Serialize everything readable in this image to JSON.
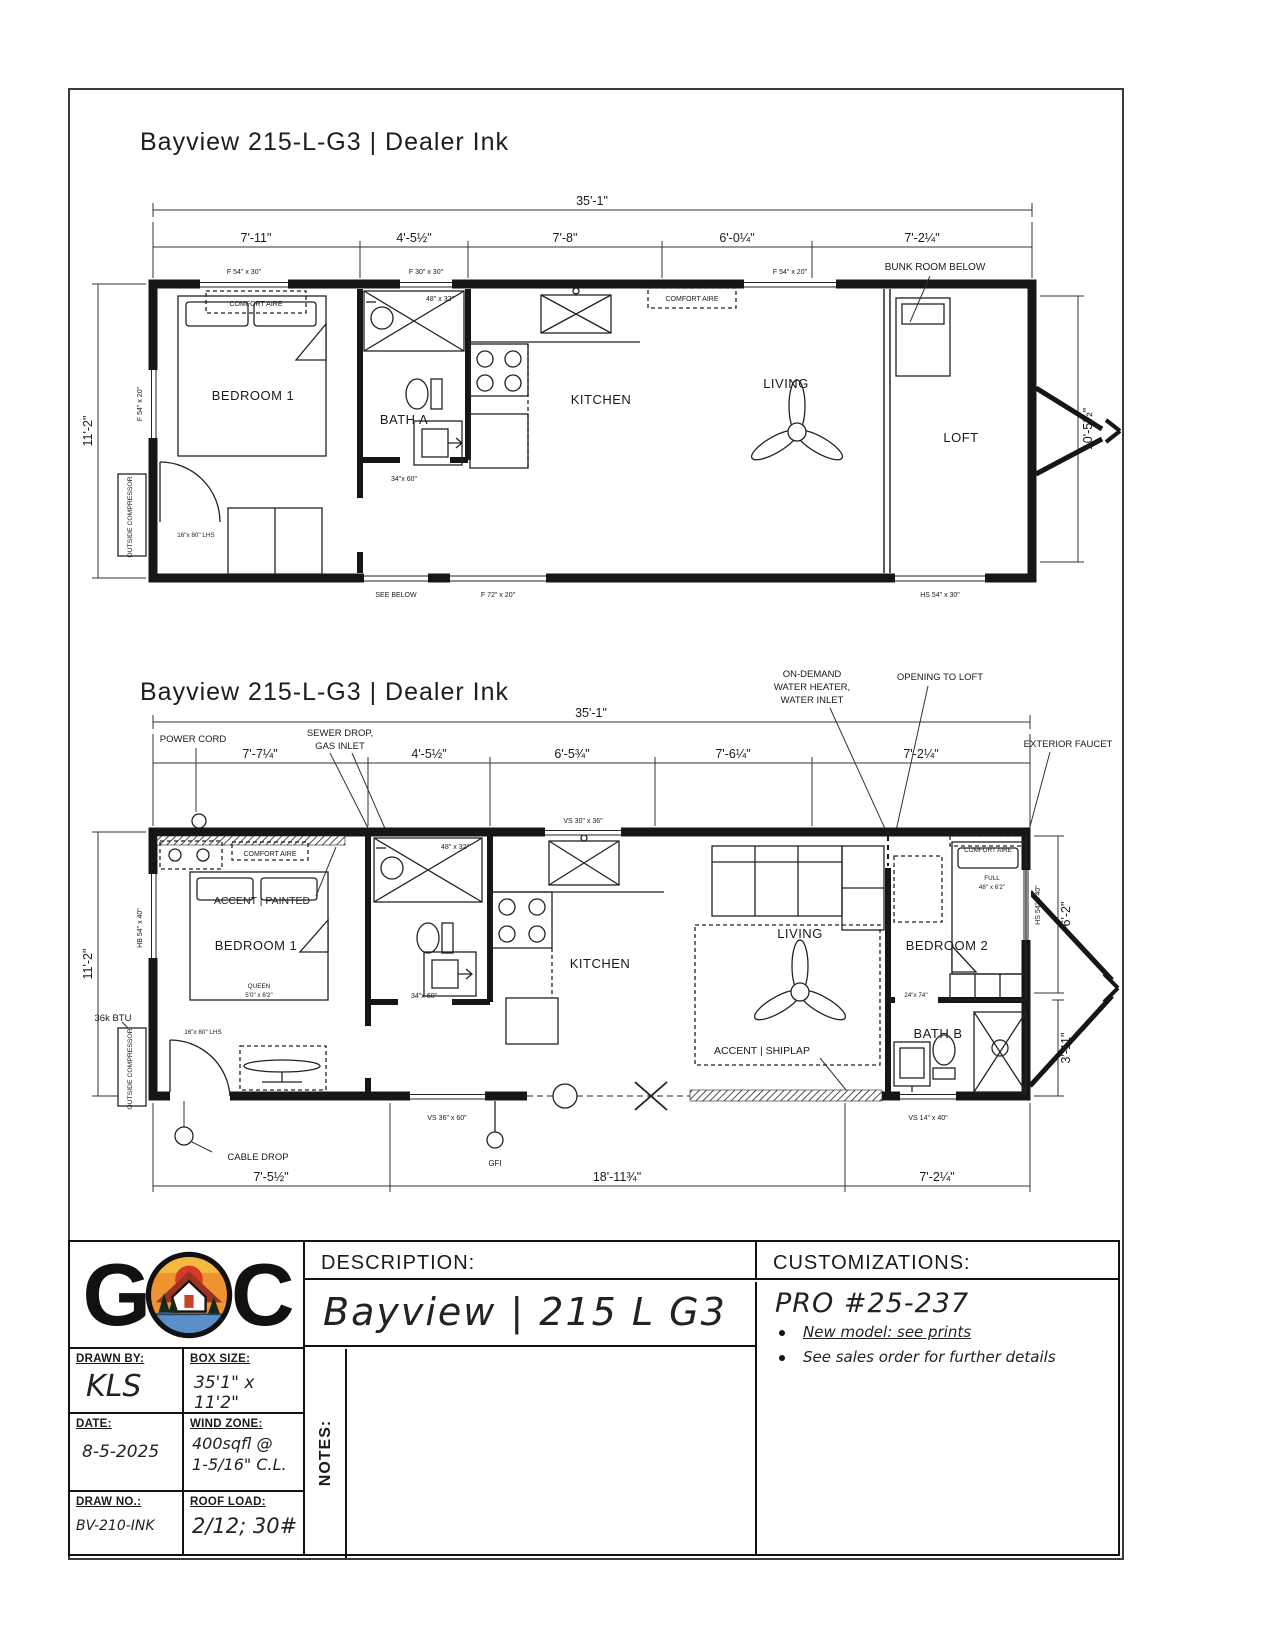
{
  "doc": {
    "title": "Bayview 215-L-G3 | Dealer Ink"
  },
  "shared": {
    "comfort_aire": "COMFORT AIRE",
    "outside_compressor": "OUTSIDE COMPRESSOR"
  },
  "plan1": {
    "overall": "35'-1\"",
    "seg": [
      "7'-11\"",
      "4'-5½\"",
      "7'-8\"",
      "6'-0¼\"",
      "7'-2¼\""
    ],
    "left": "11'-2\"",
    "right": "10'-5½\"",
    "bunk": "BUNK ROOM BELOW",
    "bedroom1": "BEDROOM 1",
    "bath": "BATH A",
    "kitchen": "KITCHEN",
    "living": "LIVING",
    "loft": "LOFT",
    "w_f5430": "F 54\" x 30\"",
    "w_f3030": "F 30\" x 30\"",
    "w_f5420": "F 54\" x 20\"",
    "w_f7220": "F 72\" x 20\"",
    "w_hs5430": "HS 54\" x 30\"",
    "see_below": "SEE BELOW",
    "shower": "48\" x 32\"",
    "d34": "34\"x 60\"",
    "d16": "16\"x 80\" LHS"
  },
  "plan2": {
    "overall": "35'-1\"",
    "seg": [
      "7'-7¼\"",
      "4'-5½\"",
      "6'-5¾\"",
      "7'-6¼\"",
      "7'-2¼\""
    ],
    "segb": [
      "7'-5½\"",
      "18'-11¾\"",
      "7'-2¼\""
    ],
    "left": "11'-2\"",
    "right_up": "6'-2\"",
    "right_low": "3'-11\"",
    "bedroom1": "BEDROOM 1",
    "bedroom2": "BEDROOM 2",
    "bath_b": "BATH B",
    "kitchen": "KITCHEN",
    "living": "LIVING",
    "queen1": "QUEEN",
    "queen2": "5'0\" x 6'2\"",
    "full1": "FULL",
    "full2": "48\" x 6'2\"",
    "accent_painted": "ACCENT | PAINTED",
    "accent_shiplap": "ACCENT | SHIPLAP",
    "btu": "36k BTU",
    "power_cord": "POWER CORD",
    "sewer1": "SEWER DROP,",
    "sewer2": "GAS INLET",
    "od1": "ON-DEMAND",
    "od2": "WATER HEATER,",
    "od3": "WATER INLET",
    "opening": "OPENING TO LOFT",
    "ext_faucet": "EXTERIOR FAUCET",
    "cable_drop": "CABLE DROP",
    "gfi": "GFI",
    "w_vs3036": "VS 30\" x 36\"",
    "w_vs3660": "VS 36\" x 60\"",
    "w_vs1440": "VS 14\" x 40\"",
    "w_hb5440": "HB 54\" x 40\"",
    "w_hs5440": "HS 54\" x 40\"",
    "shower": "48\" x 32\"",
    "d34": "34\"x 60\"",
    "d16": "16\"x 80\" LHS",
    "d24": "24\"x 74\""
  },
  "titleblock": {
    "logo_g": "G",
    "logo_c": "C",
    "desc_label": "DESCRIPTION:",
    "desc_value": "Bayview | 215 L G3",
    "cust_label": "CUSTOMIZATIONS:",
    "pro": "PRO #25-237",
    "bullet1": "New model: see prints",
    "bullet2": "See sales order for further details",
    "drawn_by_label": "DRAWN BY:",
    "drawn_by": "KLS",
    "box_size_label": "BOX SIZE:",
    "box_size": "35'1\" x 11'2\"",
    "date_label": "DATE:",
    "date": "8-5-2025",
    "wind_label": "WIND ZONE:",
    "wind1": "400sqfl @",
    "wind2": "1-5/16\" C.L.",
    "draw_no_label": "DRAW NO.:",
    "draw_no": "BV-210-INK",
    "roof_label": "ROOF LOAD:",
    "roof": "2/12; 30#",
    "notes_label": "NOTES:"
  }
}
